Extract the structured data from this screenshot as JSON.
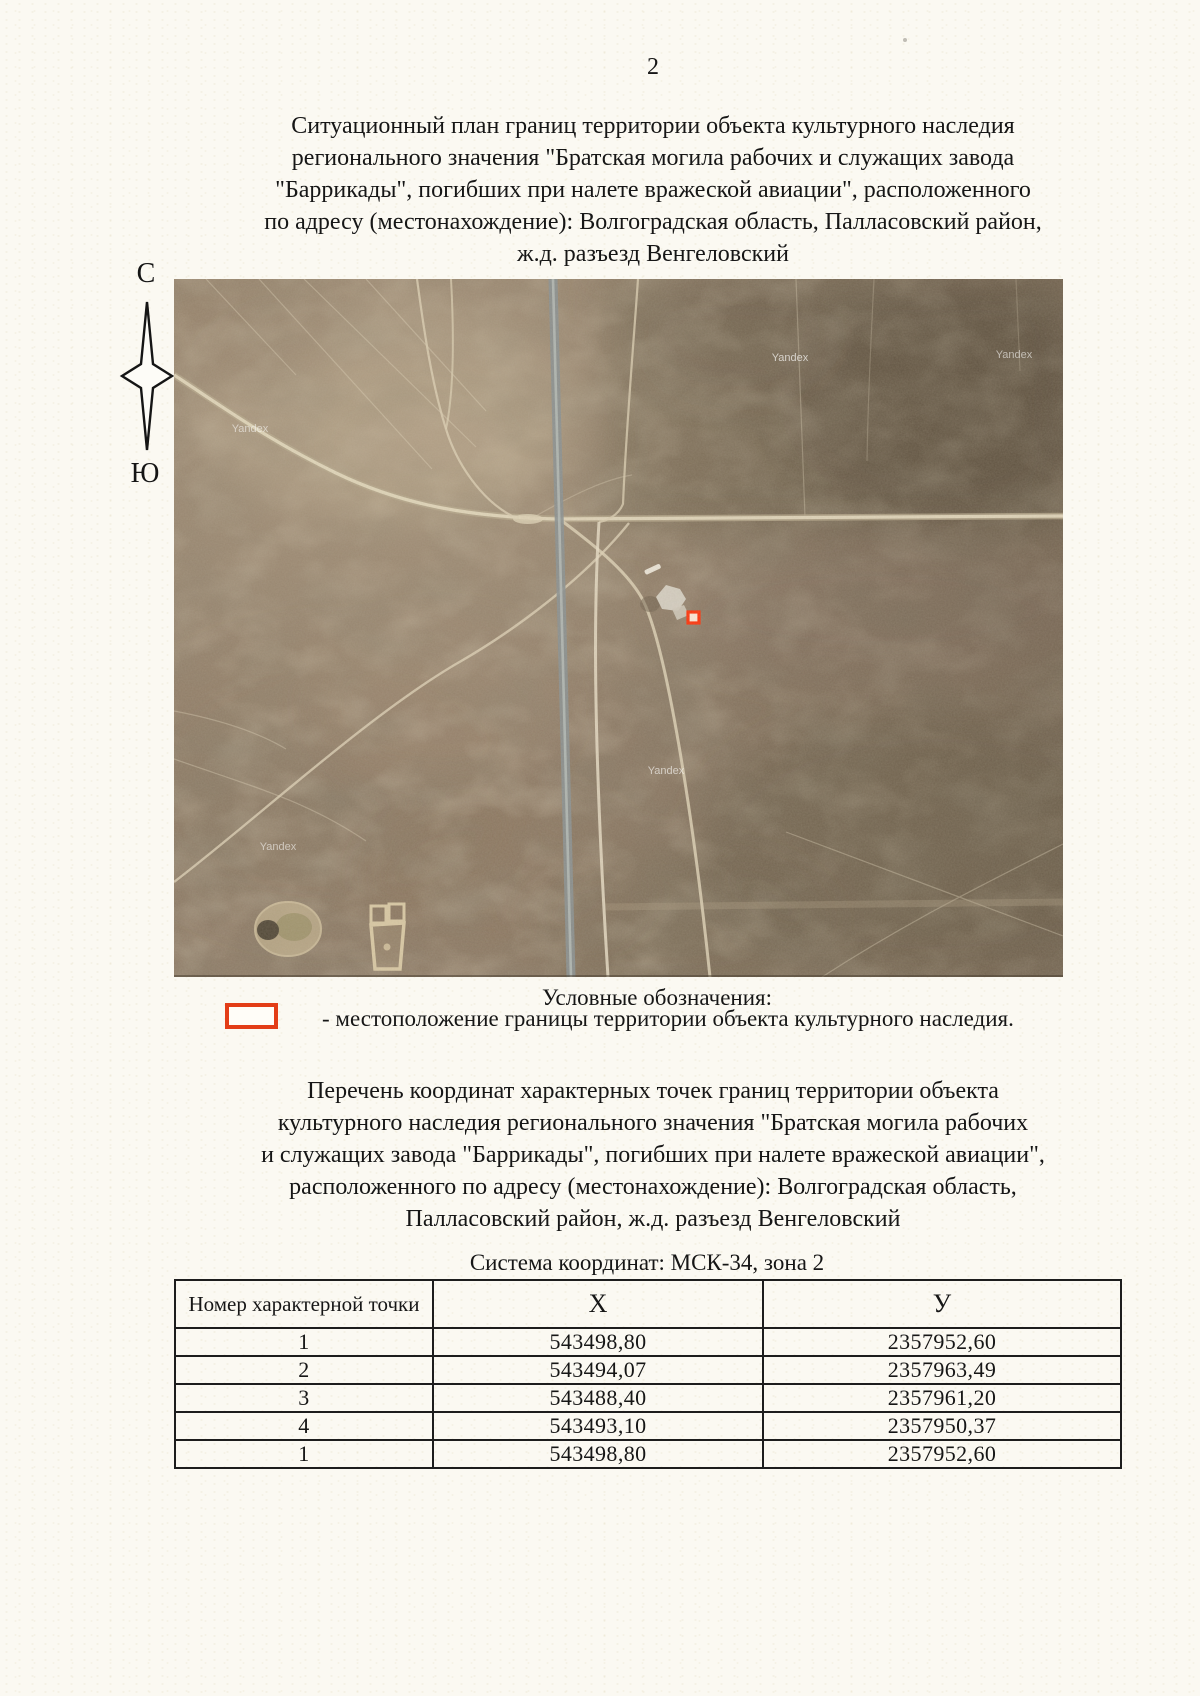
{
  "page": {
    "number": "2"
  },
  "title": {
    "lines": [
      "Ситуационный план границ территории объекта культурного наследия",
      "регионального значения \"Братская могила рабочих и служащих завода",
      "\"Баррикады\", погибших при налете вражеской авиации\", расположенного",
      "по адресу (местонахождение): Волгоградская область, Палласовский район,",
      "ж.д. разъезд Венгеловский"
    ]
  },
  "compass": {
    "north": "С",
    "south": "Ю"
  },
  "map": {
    "watermark": "Yandex",
    "marker_color": "#ff2f06"
  },
  "legend": {
    "heading": "Условные обозначения:",
    "symbol_color": "#e33d17",
    "item": "- местоположение границы территории объекта культурного наследия."
  },
  "coordinates_heading": {
    "lines": [
      "Перечень координат характерных точек границ территории объекта",
      "культурного наследия регионального значения \"Братская могила рабочих",
      "и служащих завода \"Баррикады\", погибших при налете вражеской авиации\",",
      "расположенного по адресу (местонахождение): Волгоградская область,",
      "Палласовский район, ж.д. разъезд Венгеловский"
    ]
  },
  "coordinate_system": "Система координат: МСК-34, зона 2",
  "table": {
    "headers": [
      "Номер характерной точки",
      "Х",
      "У"
    ],
    "rows": [
      [
        "1",
        "543498,80",
        "2357952,60"
      ],
      [
        "2",
        "543494,07",
        "2357963,49"
      ],
      [
        "3",
        "543488,40",
        "2357961,20"
      ],
      [
        "4",
        "543493,10",
        "2357950,37"
      ],
      [
        "1",
        "543498,80",
        "2357952,60"
      ]
    ]
  }
}
